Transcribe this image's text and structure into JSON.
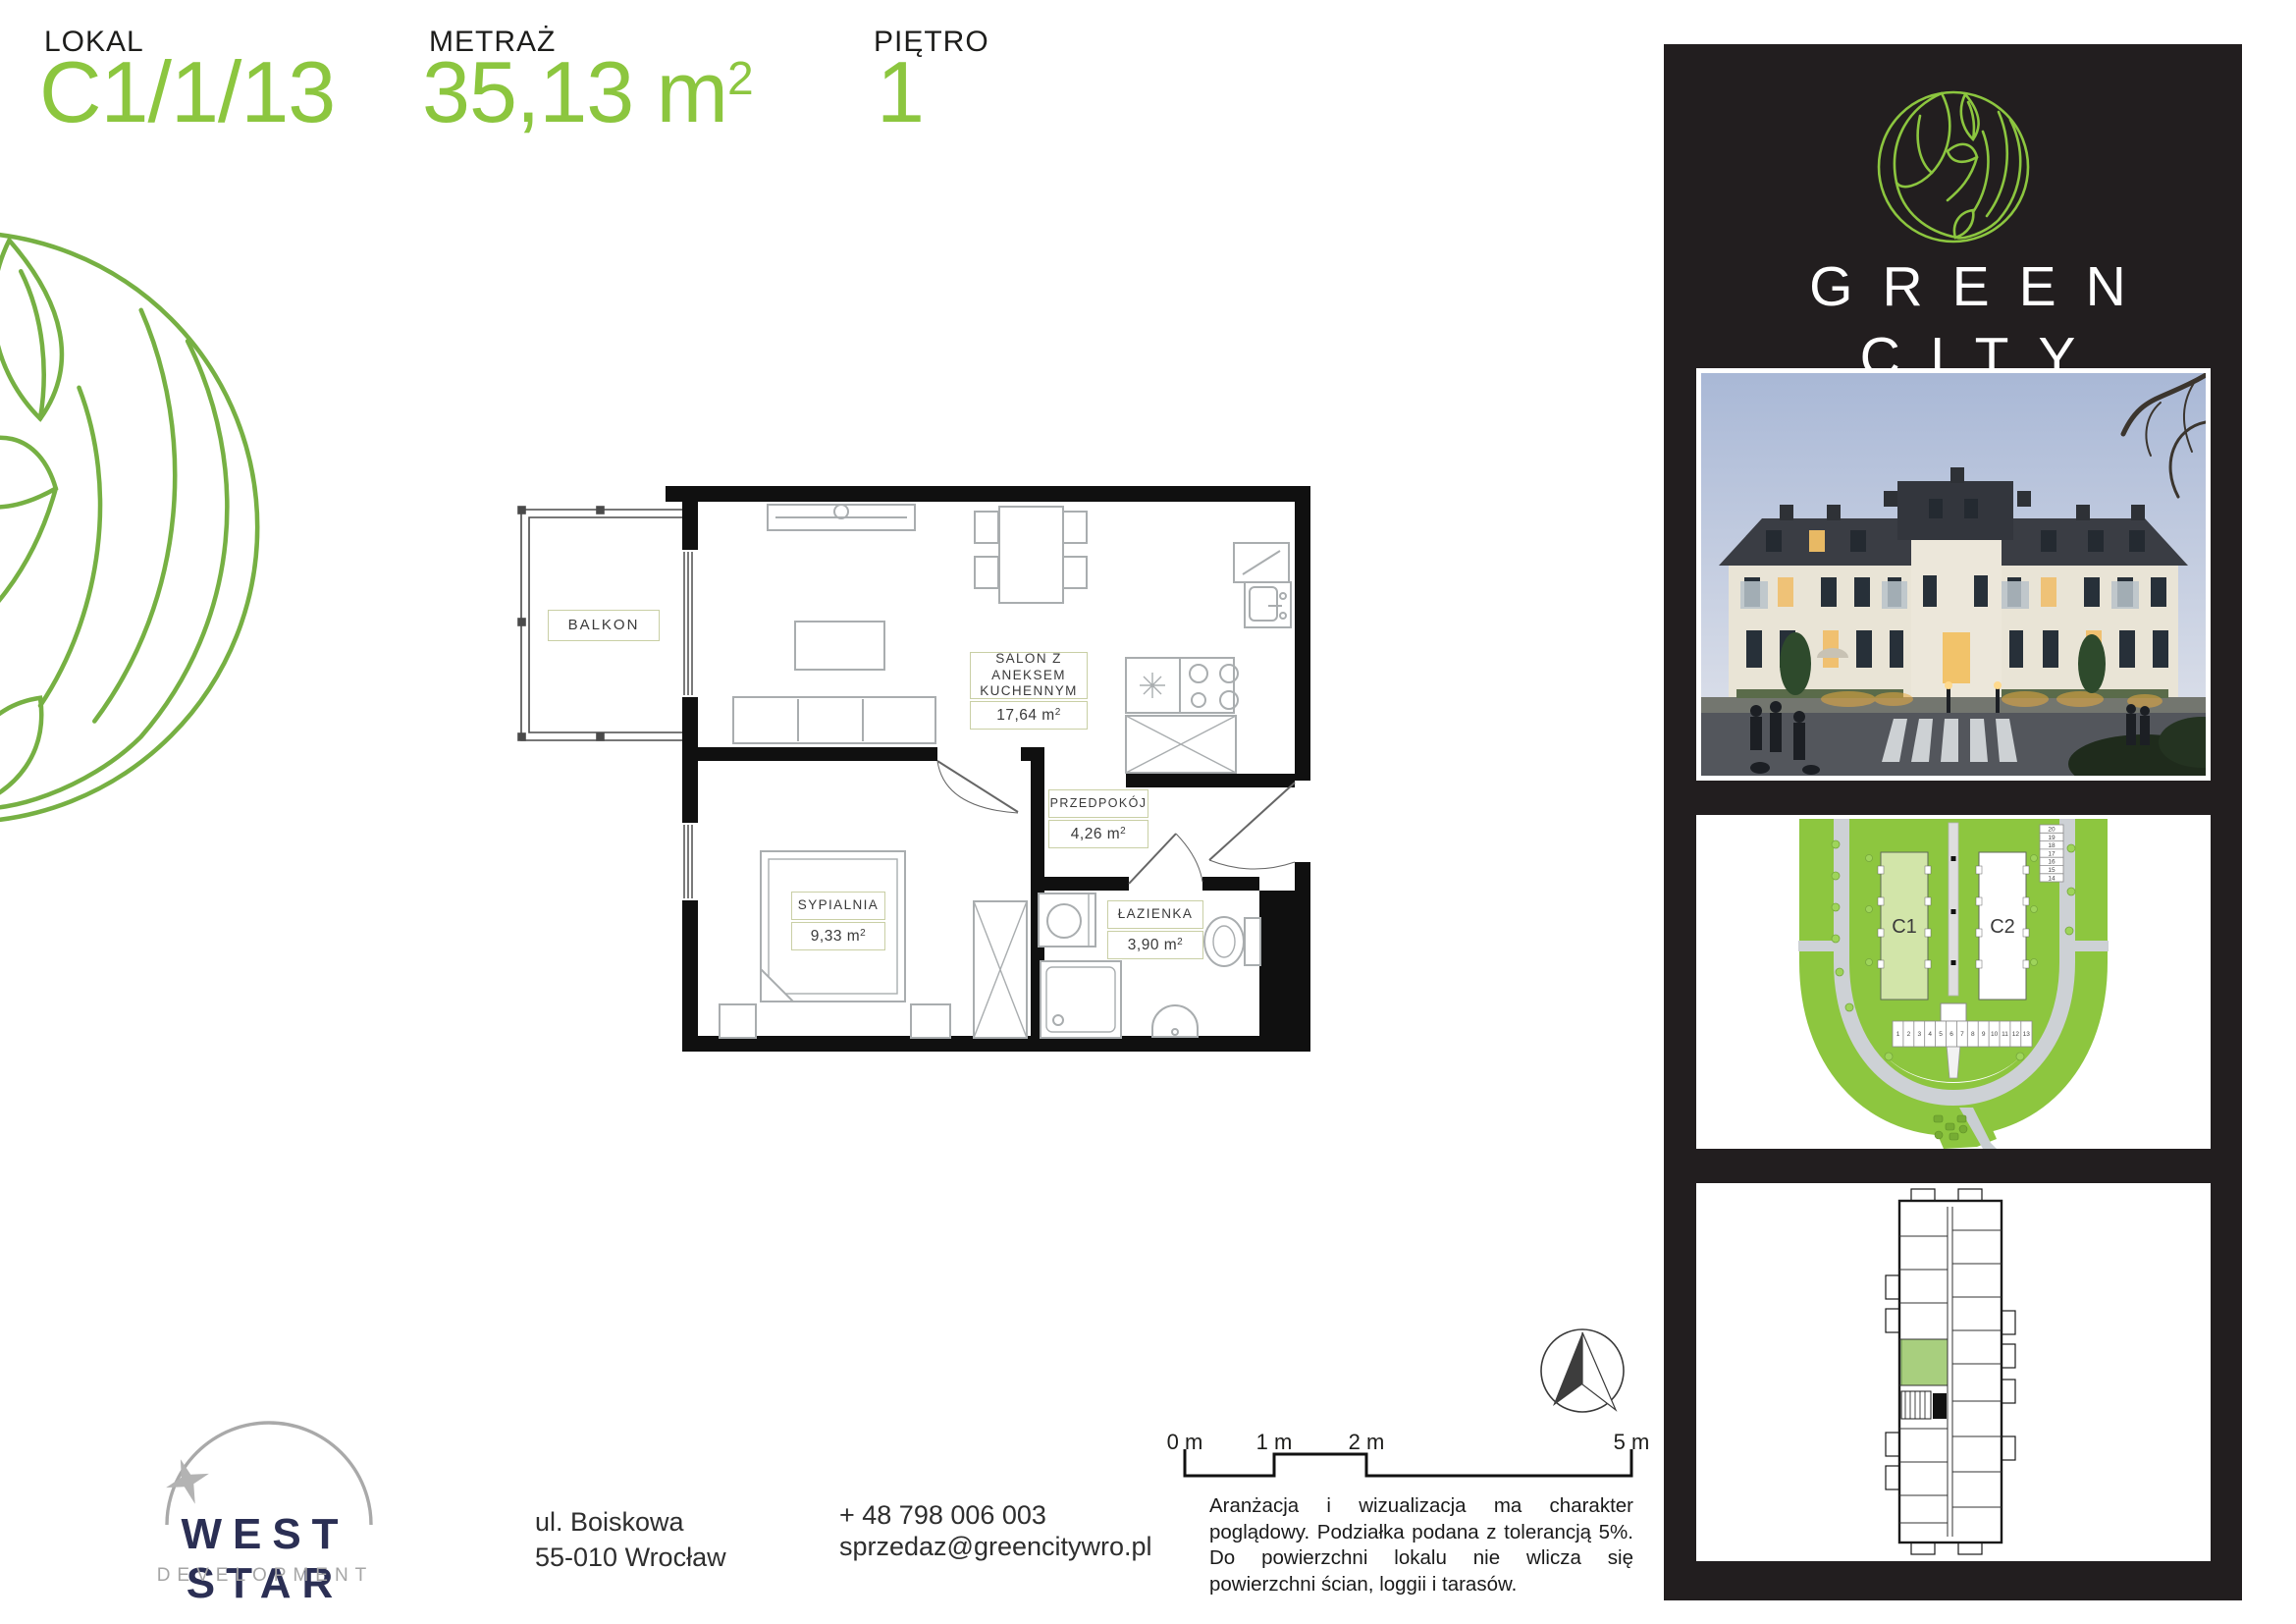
{
  "header": {
    "lokal_label": "LOKAL",
    "lokal_value": "C1/1/13",
    "metraz_label": "METRAŻ",
    "metraz_value": "35,13 m",
    "metraz_sup": "2",
    "pietro_label": "PIĘTRO",
    "pietro_value": "1"
  },
  "plan": {
    "balkon": {
      "name": "BALKON"
    },
    "salon": {
      "name_line1": "SALON Z ANEKSEM",
      "name_line2": "KUCHENNYM",
      "area": "17,64 m",
      "sup": "2"
    },
    "przedpokoj": {
      "name": "PRZEDPOKÓJ",
      "area": "4,26 m",
      "sup": "2"
    },
    "sypialnia": {
      "name": "SYPIALNIA",
      "area": "9,33 m",
      "sup": "2"
    },
    "lazienka": {
      "name": "ŁAZIENKA",
      "area": "3,90 m",
      "sup": "2"
    }
  },
  "brand": {
    "line1": "GREEN",
    "line2": "CITY"
  },
  "site_plan": {
    "building1": "C1",
    "building2": "C2",
    "parking_bottom": [
      "1",
      "2",
      "3",
      "4",
      "5",
      "6",
      "7",
      "8",
      "9",
      "10",
      "11",
      "12",
      "13"
    ],
    "parking_right": [
      "20",
      "19",
      "18",
      "17",
      "16",
      "15",
      "14"
    ]
  },
  "footer": {
    "developer_name": "WEST STAR",
    "developer_subtitle": "DEVELOPMENT",
    "address_line1": "ul. Boiskowa",
    "address_line2": "55-010 Wrocław",
    "phone": "+ 48 798 006 003",
    "email": "sprzedaz@greencitywro.pl",
    "scale_labels": [
      "0 m",
      "1 m",
      "2 m",
      "5 m"
    ],
    "disclaimer": "Aranżacja i wizualizacja ma charakter poglądowy. Podziałka podana z tolerancją 5%. Do powierzchni lokalu nie wlicza się powierzchni ścian, loggii i tarasów."
  },
  "colors": {
    "accent_green": "#8cc63f",
    "ornament_green": "#76b043",
    "panel_dark": "#221e1f",
    "navy": "#2b2f54"
  }
}
